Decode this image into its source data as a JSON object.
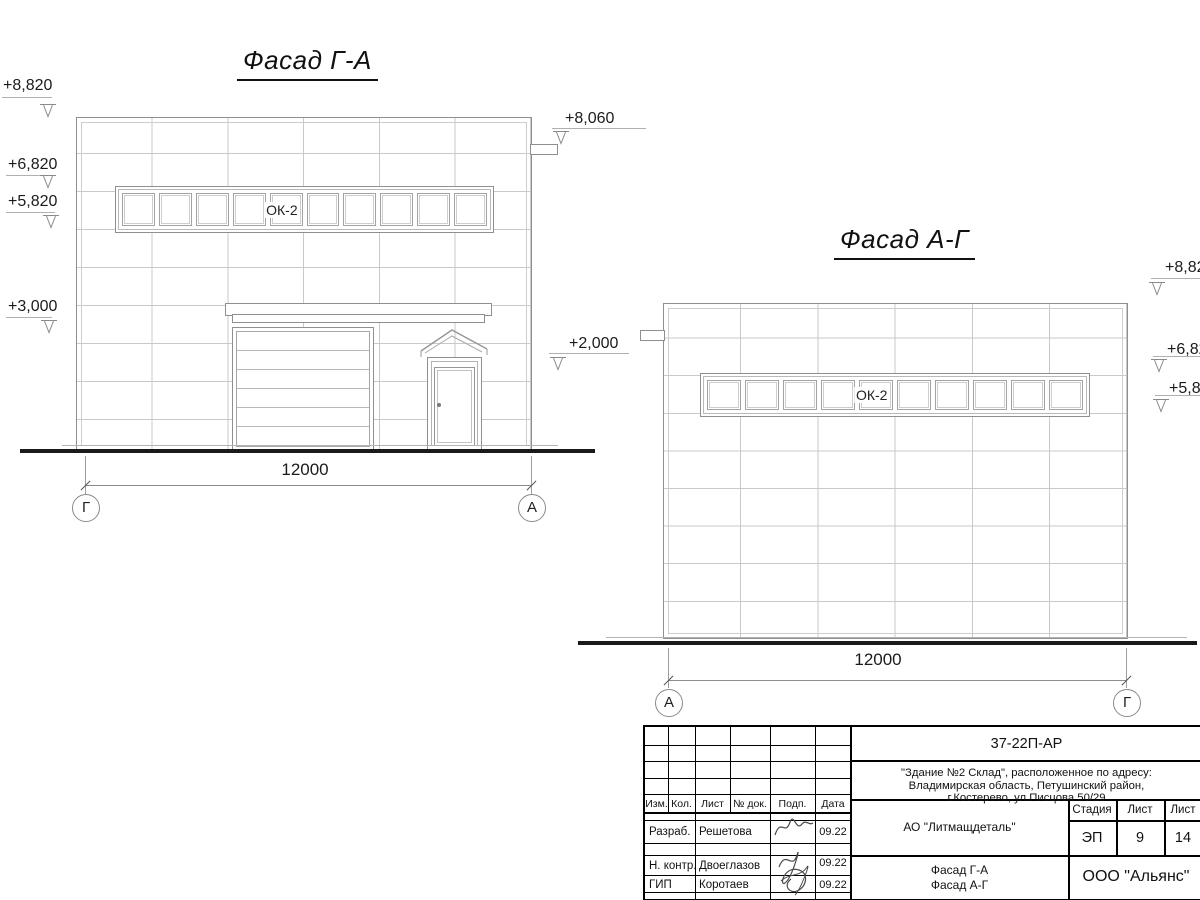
{
  "facade1": {
    "title": "Фасад Г-А",
    "window_label": "ОК-2",
    "dim": "12000",
    "axis_left": "Г",
    "axis_right": "А",
    "elev_8820": "+8,820",
    "elev_6820": "+6,820",
    "elev_5820": "+5,820",
    "elev_3000": "+3,000",
    "elev_8060": "+8,060",
    "elev_2000": "+2,000"
  },
  "facade2": {
    "title": "Фасад А-Г",
    "window_label": "ОК-2",
    "dim": "12000",
    "axis_left": "А",
    "axis_right": "Г",
    "elev_882": "+8,82",
    "elev_682": "+6,82",
    "elev_582": "+5,82"
  },
  "title_block": {
    "doc_number": "37-22П-АР",
    "address_line1": "\"Здание №2 Склад\", расположенное по адресу:",
    "address_line2": "Владимирская область, Петушинский район,",
    "address_line3": "г.Костерево, ул.Писцова 50/29",
    "col_izm": "Изм.",
    "col_kol": "Кол.",
    "col_list": "Лист",
    "col_doc": "№ док.",
    "col_podp": "Подп.",
    "col_data": "Дата",
    "row1_role": "Разраб.",
    "row1_name": "Решетова",
    "row1_date": "09.22",
    "row2_role": "Н. контр.",
    "row2_name": "Двоеглазов",
    "row2_date": "09.22",
    "row3_role": "ГИП",
    "row3_name": "Коротаев",
    "row3_date": "09.22",
    "company": "АО \"Литмащдеталь\"",
    "sheet_name1": "Фасад Г-А",
    "sheet_name2": "Фасад А-Г",
    "stage_label": "Стадия",
    "list_label": "Лист",
    "listov_label": "Лист",
    "stage": "ЭП",
    "sheet_no": "9",
    "sheets_total": "14",
    "org": "ООО \"Альянс\""
  }
}
